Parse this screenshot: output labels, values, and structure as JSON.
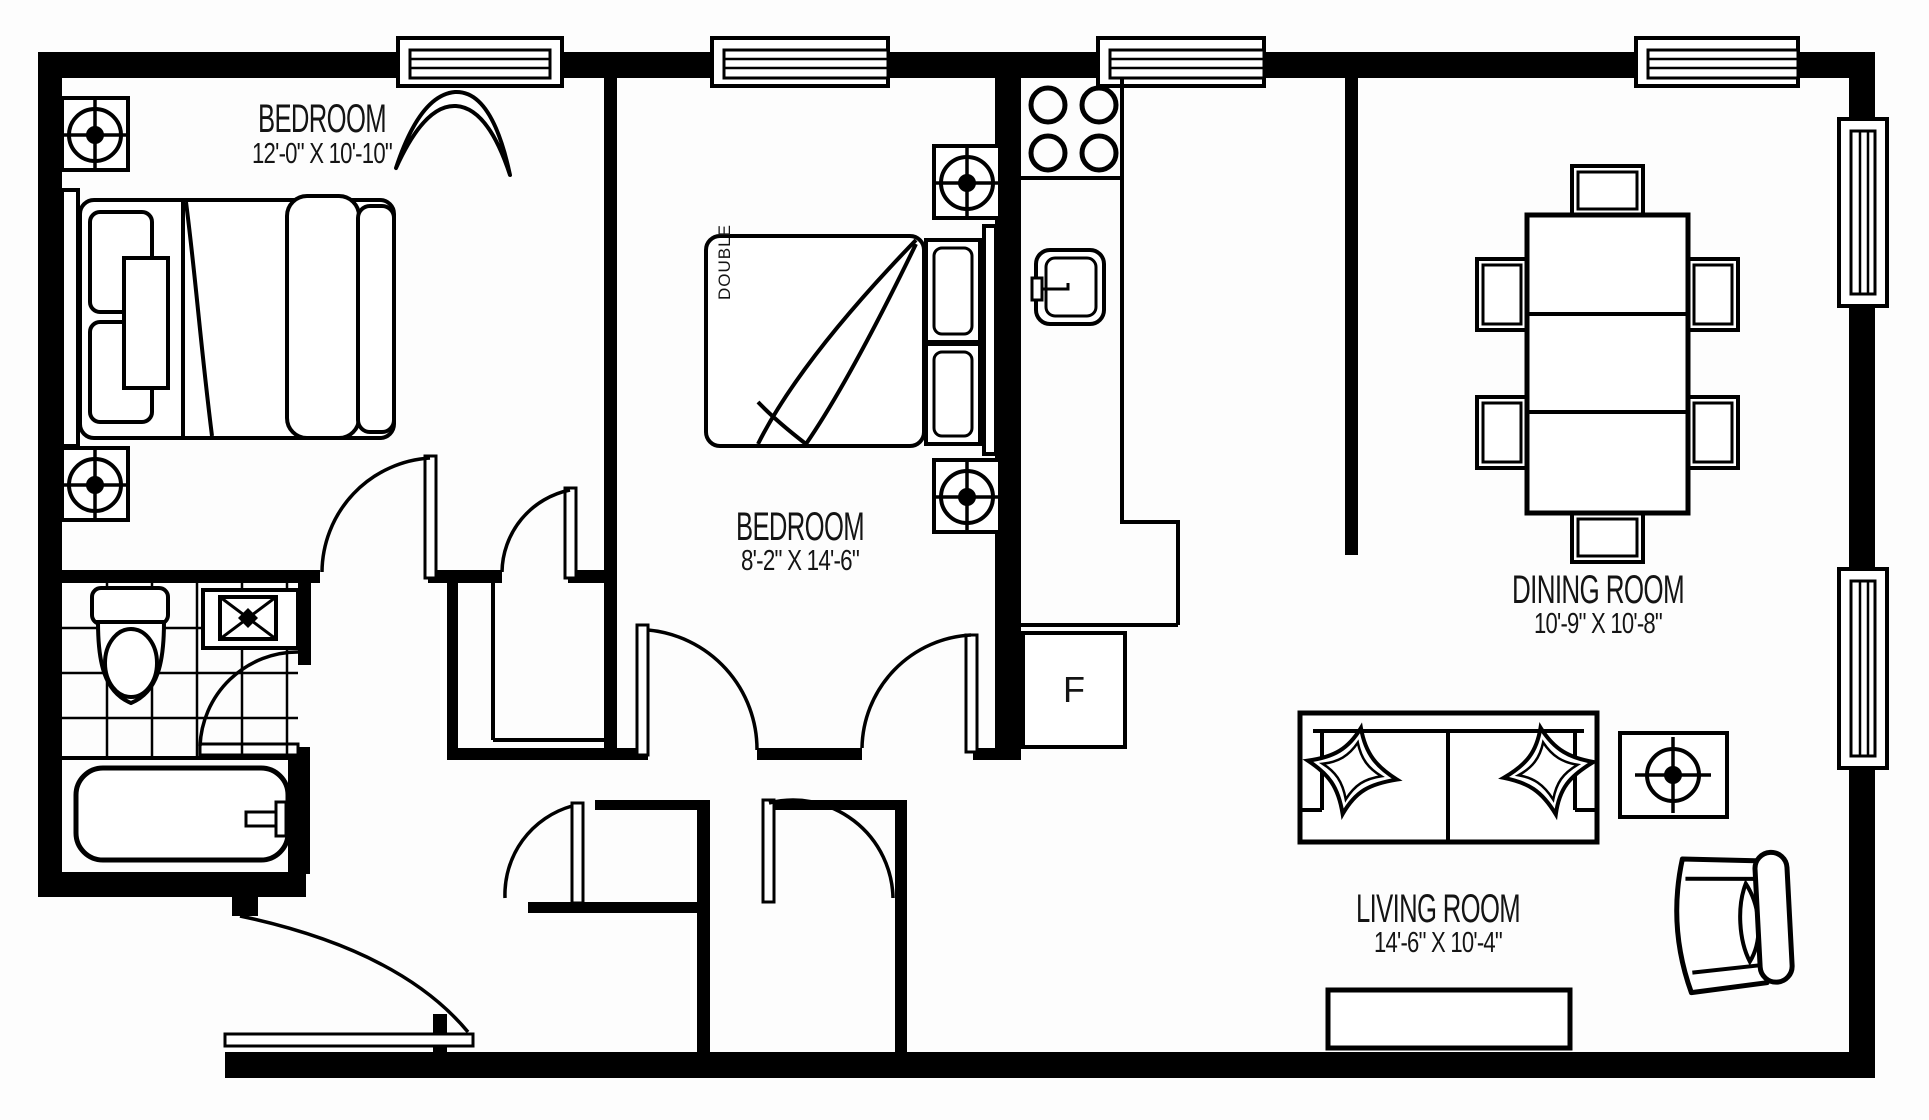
{
  "page": {
    "title": "2 Bedroom Apartment Floor Plan",
    "background": "#fdfdfd",
    "line_color": "#000000"
  },
  "rooms": [
    {
      "name": "BEDROOM",
      "dimensions": "12'-0\" X 10'-10\""
    },
    {
      "name": "BEDROOM",
      "dimensions": "8'-2\" X 14'-6\""
    },
    {
      "name": "DINING ROOM",
      "dimensions": "10'-9\" X 10'-8\""
    },
    {
      "name": "LIVING ROOM",
      "dimensions": "14'-6\" X 10'-4\""
    }
  ],
  "labels": {
    "fridge": "F",
    "bed_size": "DOUBLE"
  },
  "fixtures": [
    "double-bed",
    "bed",
    "nightstand-lamp",
    "toilet",
    "vanity-sink",
    "bathtub",
    "stove-4-burner",
    "kitchen-sink",
    "refrigerator",
    "dining-table",
    "dining-chair",
    "sofa",
    "throw-pillow",
    "side-table-lamp",
    "armchair",
    "tv-console",
    "window",
    "door"
  ]
}
